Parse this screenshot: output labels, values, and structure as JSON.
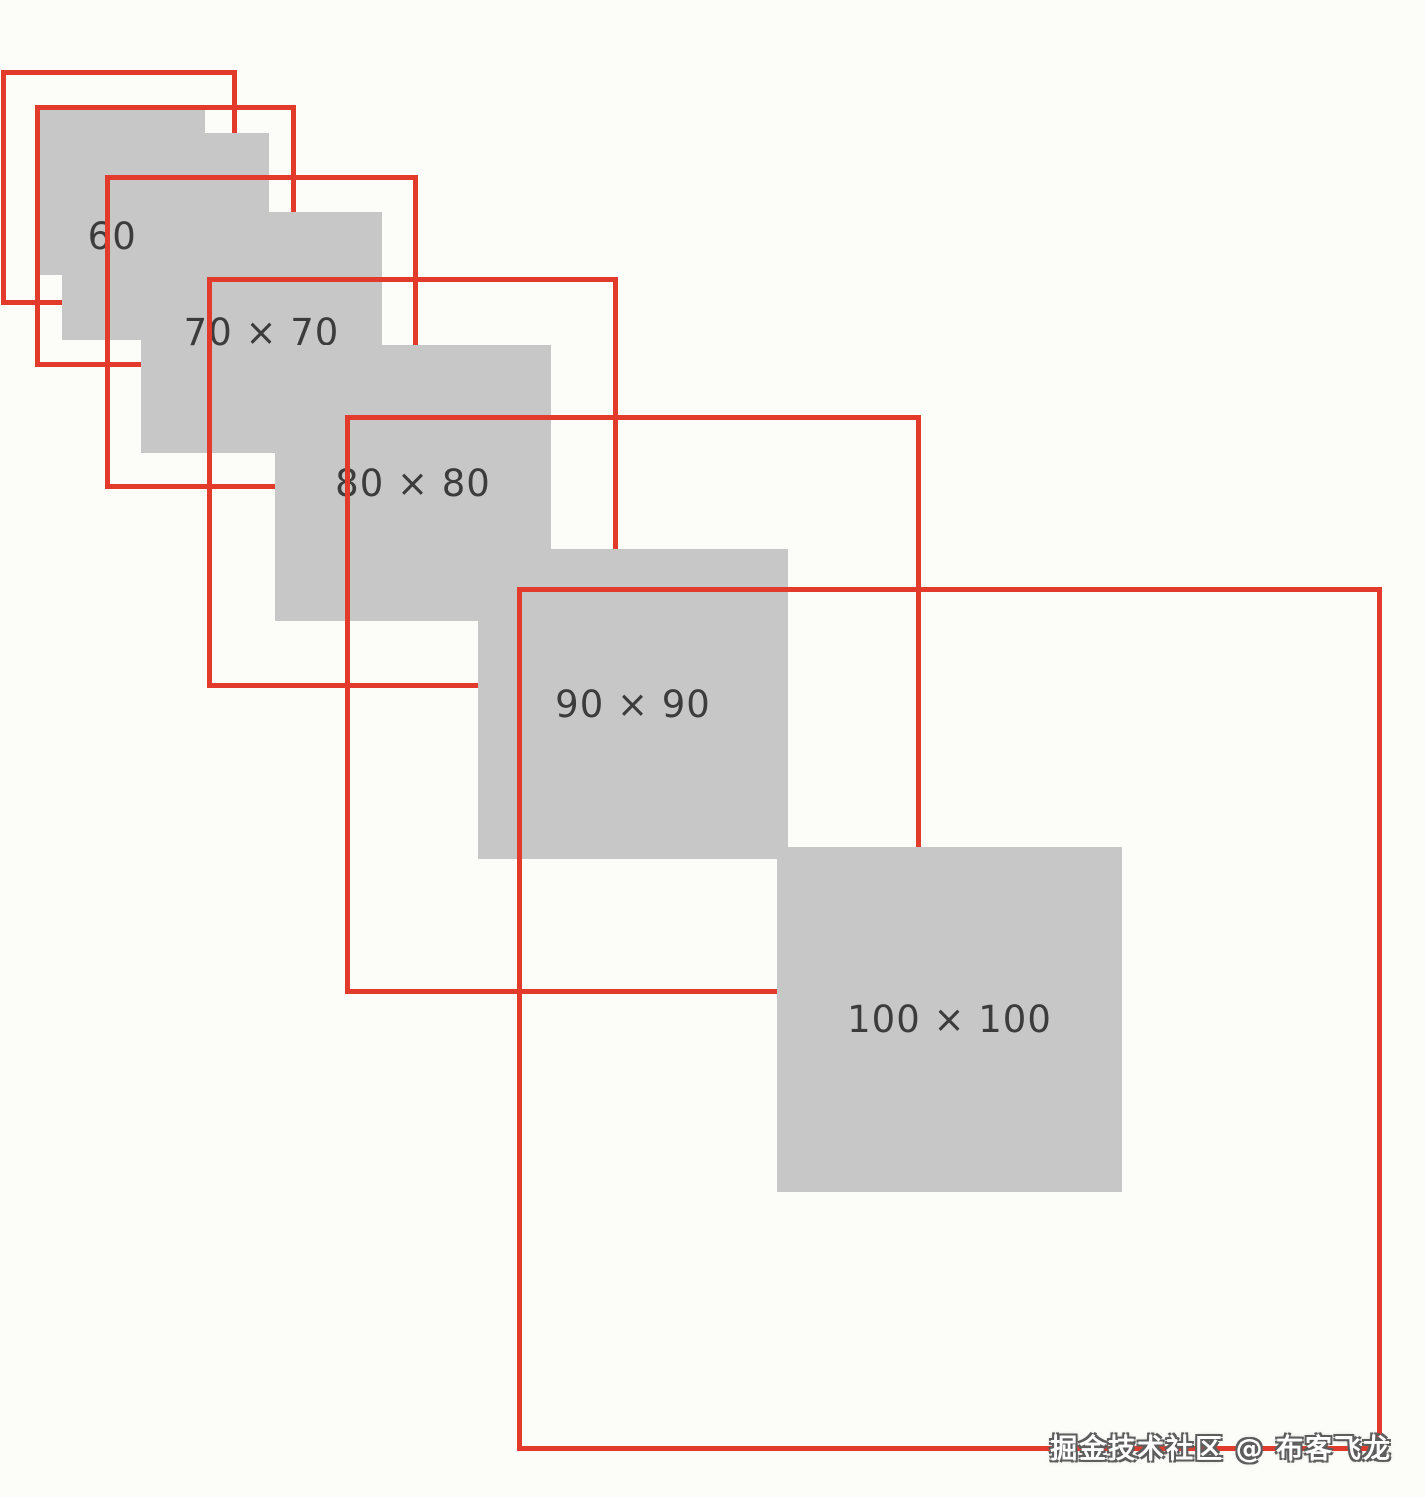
{
  "canvas": {
    "width": 1425,
    "height": 1497,
    "background": "#fcfcf9"
  },
  "style": {
    "red_border": "#e23b2c",
    "gray_fill": "#c7c7c7",
    "label_color": "#3c3c3c",
    "border_px": 5
  },
  "figure": {
    "kind": "nested-scaled-squares-demo",
    "sizes_shown": [
      60,
      70,
      80,
      90,
      100
    ]
  },
  "squares": [
    {
      "kind": "outline",
      "id": "50",
      "x": 1,
      "y": 70,
      "w": 236,
      "h": 235,
      "label": ""
    },
    {
      "kind": "fill",
      "id": "50",
      "x": 37,
      "y": 107,
      "w": 168,
      "h": 168,
      "label": ""
    },
    {
      "kind": "outline",
      "id": "60",
      "x": 35,
      "y": 105,
      "w": 261,
      "h": 262,
      "label": ""
    },
    {
      "kind": "fill",
      "id": "60",
      "x": 62,
      "y": 133,
      "w": 207,
      "h": 207,
      "label": "60 × 60"
    },
    {
      "kind": "outline",
      "id": "70",
      "x": 105,
      "y": 175,
      "w": 313,
      "h": 314,
      "label": ""
    },
    {
      "kind": "fill",
      "id": "70",
      "x": 141,
      "y": 212,
      "w": 241,
      "h": 241,
      "label": "70 × 70"
    },
    {
      "kind": "outline",
      "id": "80",
      "x": 207,
      "y": 277,
      "w": 411,
      "h": 411,
      "label": ""
    },
    {
      "kind": "fill",
      "id": "80",
      "x": 275,
      "y": 345,
      "w": 276,
      "h": 276,
      "label": "80 × 80"
    },
    {
      "kind": "outline",
      "id": "90",
      "x": 345,
      "y": 415,
      "w": 576,
      "h": 579,
      "label": ""
    },
    {
      "kind": "fill",
      "id": "90",
      "x": 478,
      "y": 549,
      "w": 310,
      "h": 310,
      "label": "90 × 90"
    },
    {
      "kind": "outline",
      "id": "100",
      "x": 517,
      "y": 587,
      "w": 865,
      "h": 864,
      "label": ""
    },
    {
      "kind": "fill",
      "id": "100",
      "x": 777,
      "y": 847,
      "w": 345,
      "h": 345,
      "label": "100 × 100"
    }
  ],
  "watermark": {
    "text": "掘金技术社区 @ 布客飞龙"
  }
}
